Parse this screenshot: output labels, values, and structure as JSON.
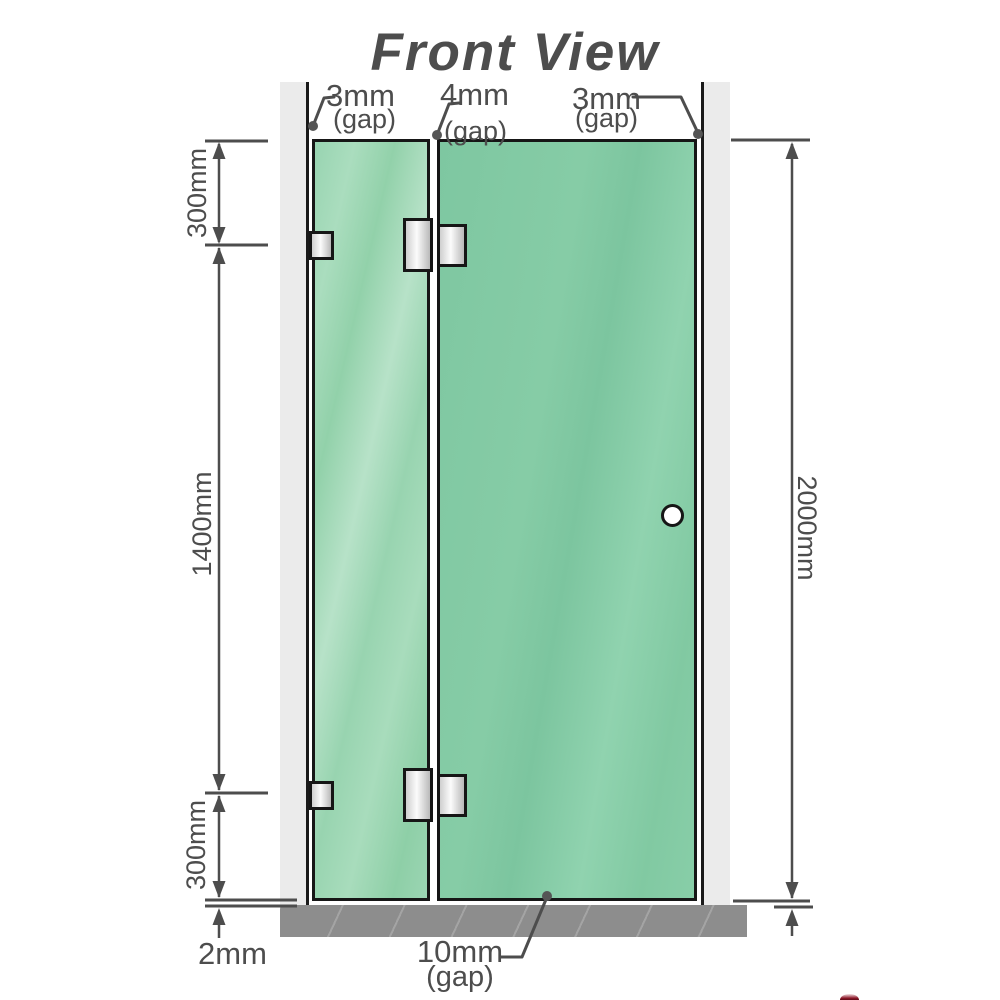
{
  "title": "Front View",
  "gaps": {
    "top_left": {
      "value": "3mm",
      "unit": "(gap)"
    },
    "top_middle": {
      "value": "4mm",
      "unit": "(gap)"
    },
    "top_right": {
      "value": "3mm",
      "unit": "(gap)"
    },
    "bottom": {
      "value": "10mm",
      "unit": "(gap)"
    },
    "floor": {
      "value": "2mm"
    }
  },
  "dimensions": {
    "left_top": "300mm",
    "left_middle": "1400mm",
    "left_bottom": "300mm",
    "right_overall": "2000mm"
  },
  "colors": {
    "glass_fixed_panel": "#9dd6b6",
    "glass_door_panel": "#80c8a2",
    "wall": "#ebebeb",
    "floor": "#8d8d8d",
    "dimension_lines": "#4d4d4d",
    "title_text": "#9b9b9b",
    "outline": "#161616",
    "hardware_fill": "#e8e8e8"
  }
}
